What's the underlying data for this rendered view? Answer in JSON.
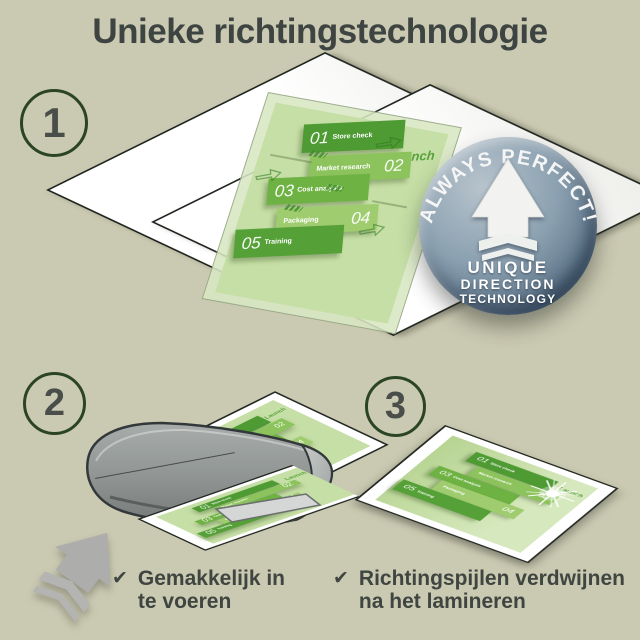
{
  "title": "Unieke richtingstechnologie",
  "steps": [
    {
      "number": "1"
    },
    {
      "number": "2"
    },
    {
      "number": "3"
    }
  ],
  "badge": {
    "arc_text": "ALWAYS PERFECT!",
    "line1": "UNIQUE",
    "line2": "DIRECTION",
    "line3": "TECHNOLOGY"
  },
  "infographic": {
    "launch_label": "Launch",
    "items": [
      {
        "num": "01",
        "label": "Store check"
      },
      {
        "num": "02",
        "label": "Market research"
      },
      {
        "num": "03",
        "label": "Cost analysis"
      },
      {
        "num": "04",
        "label": "Packaging"
      },
      {
        "num": "05",
        "label": "Training"
      }
    ]
  },
  "checklist": [
    {
      "check": "✔",
      "lines": [
        "Gemakkelijk in",
        "te voeren"
      ]
    },
    {
      "check": "✔",
      "lines": [
        "Richtingspijlen verdwijnen",
        "na het lamineren"
      ]
    }
  ],
  "icons": {
    "check": "✔",
    "up_arrow": "direction arrow with chevrons",
    "sparkle": "shine starburst",
    "direction_arrow": "pouch direction arrow"
  },
  "colors": {
    "background": "#cac9b1",
    "text_dark": "#3e4441",
    "circle_green": "#2b4524",
    "green_dark": "#4e9a33",
    "green_mid": "#6eb243",
    "green_light": "#8cc35c",
    "green_pale": "#c6dfa6",
    "badge_blue": "#6d8496",
    "machine_gray": "#8f9493",
    "arrow_gray": "#adadab"
  }
}
